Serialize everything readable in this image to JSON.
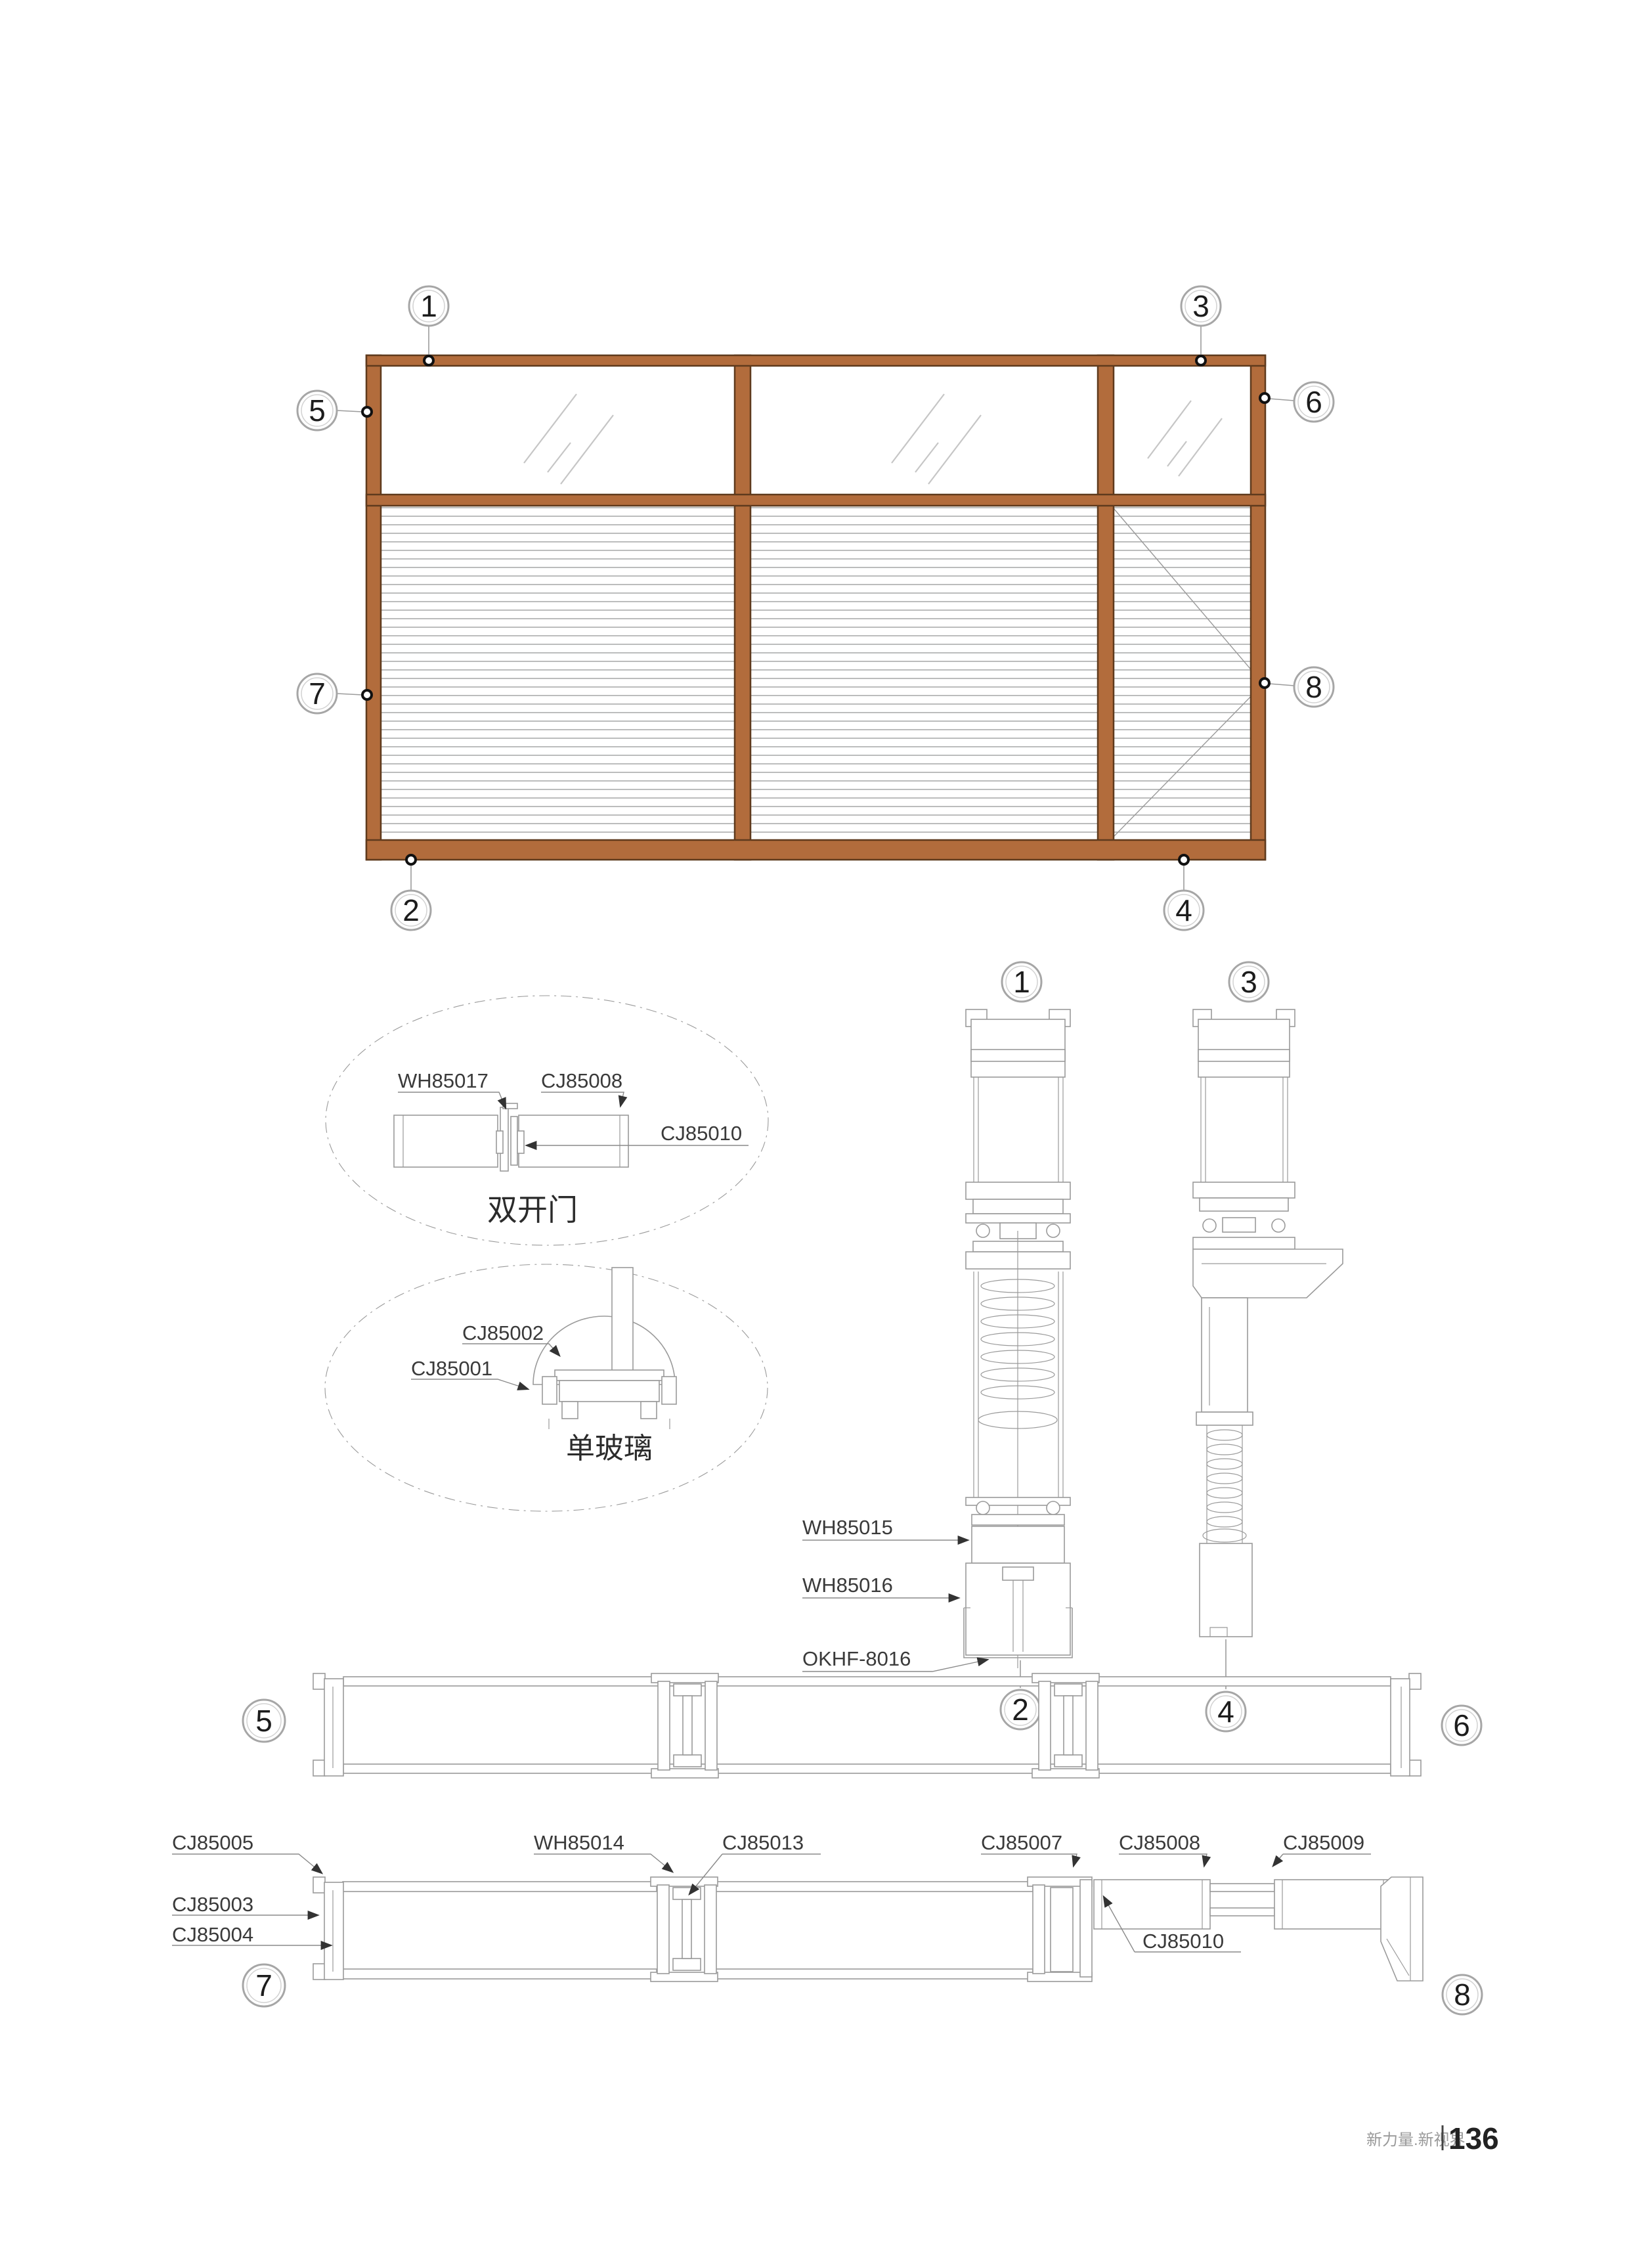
{
  "colors": {
    "frame": "#b26c3c",
    "frame_dark": "#5f3a1d",
    "line": "#9a9a9a",
    "leader": "#8a8a8a",
    "label": "#3a3a3a",
    "glass_mark": "#c6c6c6",
    "louver": "#9fa0a0"
  },
  "callouts": {
    "c1": "1",
    "c2": "2",
    "c3": "3",
    "c4": "4",
    "c5": "5",
    "c6": "6",
    "c7": "7",
    "c8": "8"
  },
  "details": {
    "double_door": {
      "caption": "双开门",
      "parts": {
        "wh85017": "WH85017",
        "cj85008": "CJ85008",
        "cj85010": "CJ85010"
      }
    },
    "single_glass": {
      "caption": "单玻璃",
      "parts": {
        "cj85002": "CJ85002",
        "cj85001": "CJ85001"
      }
    }
  },
  "sections": {
    "vertical_parts": {
      "wh85015": "WH85015",
      "wh85016": "WH85016",
      "okhf8016": "OKHF-8016"
    },
    "horizontal_parts": {
      "cj85005": "CJ85005",
      "cj85003": "CJ85003",
      "cj85004": "CJ85004",
      "wh85014": "WH85014",
      "cj85013": "CJ85013",
      "cj85007": "CJ85007",
      "cj85008": "CJ85008",
      "cj85009": "CJ85009",
      "cj85010": "CJ85010"
    }
  },
  "footer": {
    "brand": "新力量.新视界",
    "page": "136"
  }
}
